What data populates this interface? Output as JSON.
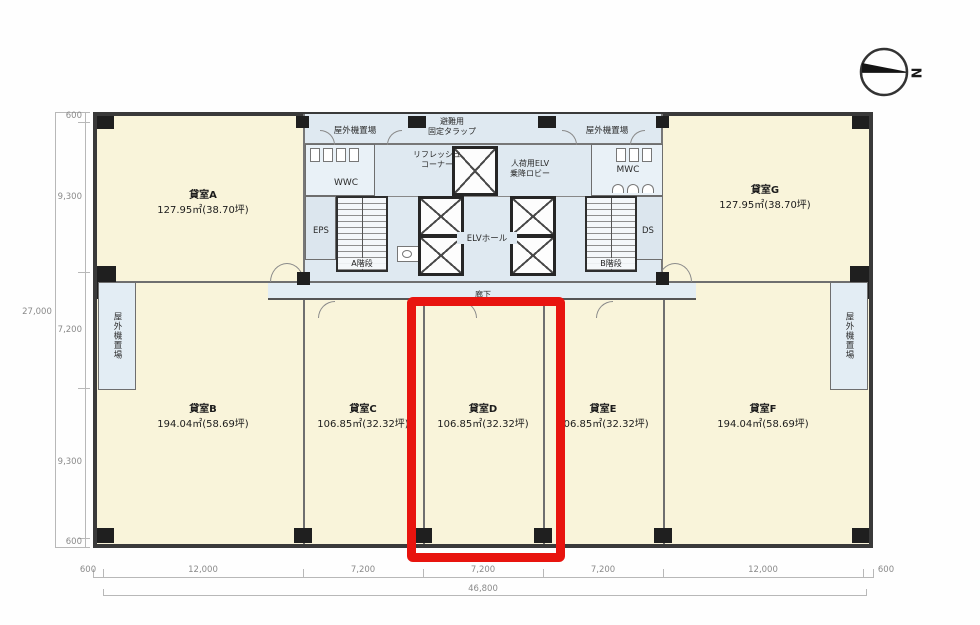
{
  "compass": {
    "north_label": "N"
  },
  "rooms": {
    "a": {
      "name": "貸室A",
      "area": "127.95㎡(38.70坪)"
    },
    "b": {
      "name": "貸室B",
      "area": "194.04㎡(58.69坪)"
    },
    "c": {
      "name": "貸室C",
      "area": "106.85㎡(32.32坪)"
    },
    "d": {
      "name": "貸室D",
      "area": "106.85㎡(32.32坪)"
    },
    "e": {
      "name": "貸室E",
      "area": "106.85㎡(32.32坪)"
    },
    "f": {
      "name": "貸室F",
      "area": "194.04㎡(58.69坪)"
    },
    "g": {
      "name": "貸室G",
      "area": "127.95㎡(38.70坪)"
    }
  },
  "core": {
    "outdoor_unit_top_left": "屋外機置場",
    "outdoor_unit_top_right": "屋外機置場",
    "outdoor_unit_side_left": "屋外機置場",
    "outdoor_unit_side_right": "屋外機置場",
    "escape_hatch": "避難用\n固定タラップ",
    "refresh_corner": "リフレッシュ\nコーナー",
    "service_elv_lobby": "人荷用ELV\n乗降ロビー",
    "wwc": "WWC",
    "mwc": "MWC",
    "eps": "EPS",
    "ds": "DS",
    "stair_a": "A階段",
    "stair_b": "B階段",
    "elv_hall": "ELVホール",
    "corridor": "廊下"
  },
  "dimensions": {
    "left": {
      "total": "27,000",
      "segments": [
        "600",
        "9,300",
        "7,200",
        "9,300",
        "600"
      ]
    },
    "bottom": {
      "total": "46,800",
      "segments": [
        "600",
        "12,000",
        "7,200",
        "7,200",
        "7,200",
        "12,000",
        "600"
      ]
    }
  },
  "highlight": {
    "room": "貸室D",
    "color": "#e8140e"
  },
  "colors": {
    "room_fill": "#f9f4da",
    "core_fill": "#dfe9f1",
    "wall": "#3a3a3a",
    "dimension_text": "#8a8a8a"
  }
}
